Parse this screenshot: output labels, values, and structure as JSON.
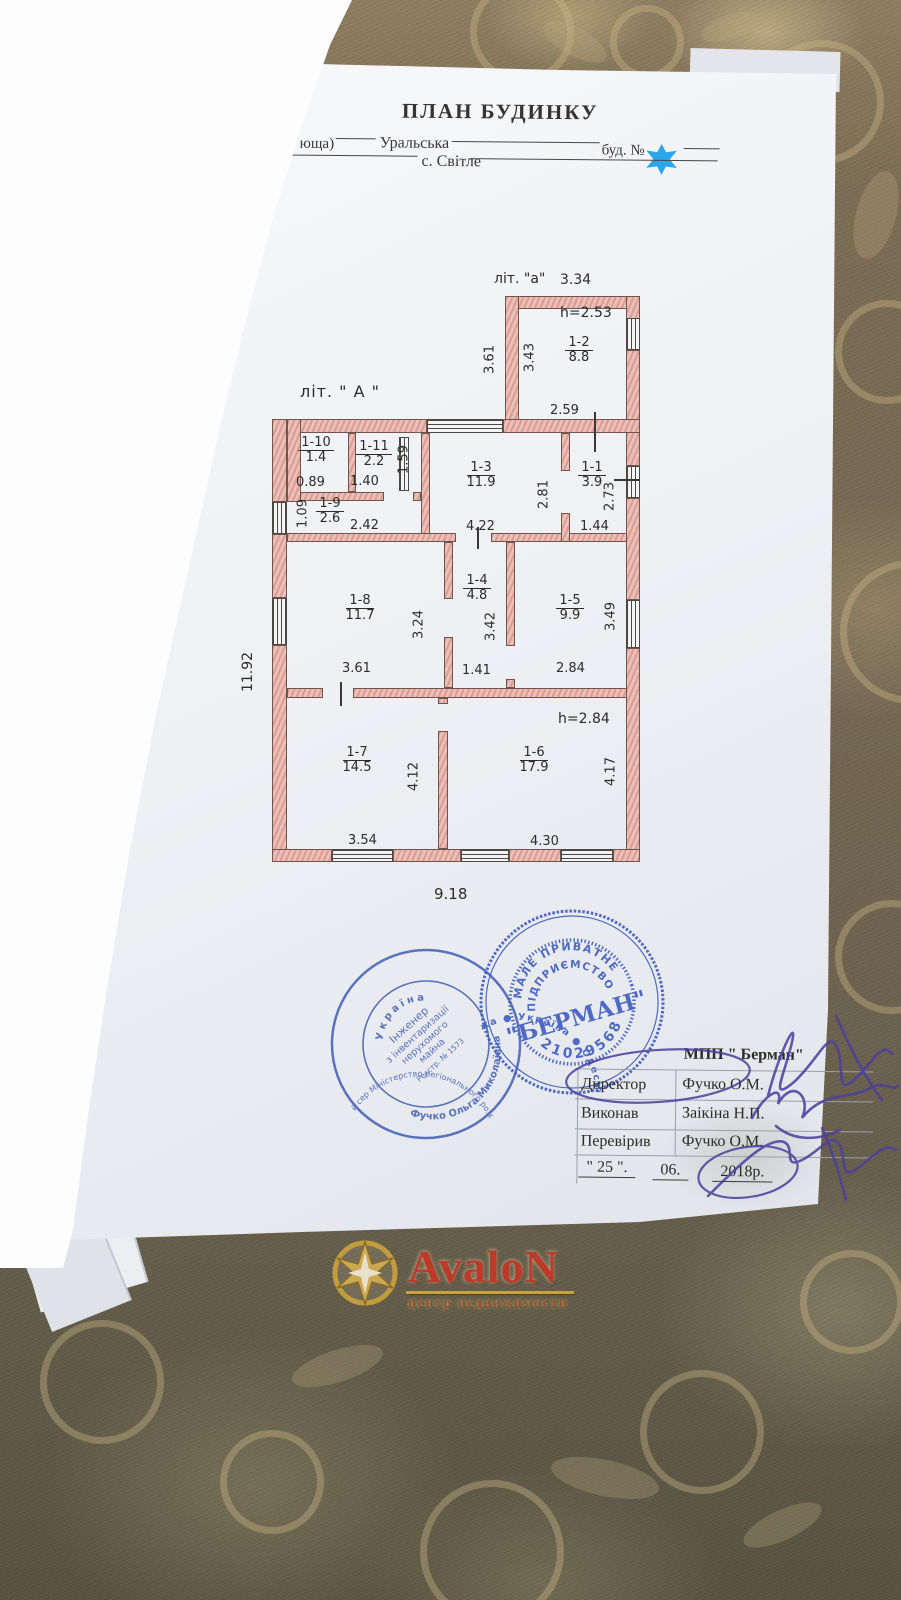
{
  "document": {
    "title": "ПЛАН БУДИНКУ",
    "address": {
      "line1_prefix": "юща)",
      "street": "Уральська",
      "house_label": "буд. №",
      "line2_prefix": ")",
      "settlement": "с. Світле"
    }
  },
  "plan": {
    "main_label": "літ. \" А \"",
    "annex_label": "літ. \"а\"",
    "annex": {
      "top": "3.34",
      "height_note": "h=2.53",
      "outer_side": "3.61",
      "inner_side": "3.43",
      "room_id": "1-2",
      "room_area": "8.8",
      "bottom": "2.59"
    },
    "overall": {
      "left_side": "11.92",
      "bottom_side": "9.18",
      "height_note": "h=2.84"
    },
    "rooms": [
      {
        "id": "1-10",
        "area": "1.4",
        "w": "0.89"
      },
      {
        "id": "1-11",
        "area": "2.2",
        "h": "1.59",
        "w": "1.40"
      },
      {
        "id": "1-9",
        "area": "2.6",
        "h": "1.09",
        "w": "2.42"
      },
      {
        "id": "1-3",
        "area": "11.9",
        "w": "4.22",
        "h": "2.81"
      },
      {
        "id": "1-1",
        "area": "3.9",
        "h": "2.73",
        "w": "1.44"
      },
      {
        "id": "1-8",
        "area": "11.7",
        "h": "3.24",
        "w": "3.61"
      },
      {
        "id": "1-4",
        "area": "4.8",
        "h": "3.42",
        "w": "1.41"
      },
      {
        "id": "1-5",
        "area": "9.9",
        "h": "3.49",
        "w": "2.84"
      },
      {
        "id": "1-7",
        "area": "14.5",
        "h": "4.12",
        "w": "3.54"
      },
      {
        "id": "1-6",
        "area": "17.9",
        "h": "4.17",
        "w": "4.30"
      }
    ]
  },
  "stamps": {
    "engineer": {
      "country": "Україна",
      "title_l1": "Інженер",
      "title_l2": "з інвентаризації",
      "title_l3": "нерухомого",
      "title_l4": "майна",
      "reg": "Реєстр. № 1573",
      "name": "Фучко Ольга Миколаївна",
      "ring": "Міністерство регіонального розвитку будівництва та житлово-комунального господарства ● Кваліфікаційний сертифікат АЕ ●"
    },
    "berman": {
      "arc_top1": "МАЛЕ ПРИВАТНЕ",
      "arc_top2": "ПІДПРИЄМСТВО",
      "name": "\"БЕРМАН\"",
      "code": "21029568",
      "ring": "● Україна ● Одеська область ● Комінтернівський район ● с. Крижанівка"
    }
  },
  "signoff": {
    "org": "МПП \" Берман\"",
    "rows": [
      {
        "role": "Директор",
        "name": "Фучко О.М."
      },
      {
        "role": "Виконав",
        "name": "Заікіна Н.П."
      },
      {
        "role": "Перевірив",
        "name": "Фучко О,М."
      }
    ],
    "date": {
      "day": "\" 25 \".",
      "month": "06.",
      "year": "2018р."
    }
  },
  "watermark": {
    "brand": "AvaloN",
    "subtitle": "центр недвижимости"
  },
  "colors": {
    "stamp_blue": "#3f5dc0",
    "wall_pink": "#eac6c0",
    "signature_purple": "#4b3f9f",
    "redaction_star_blue": "#2aa7ea",
    "watermark_red": "#bc3a2a",
    "watermark_gold": "#c9a23f"
  }
}
